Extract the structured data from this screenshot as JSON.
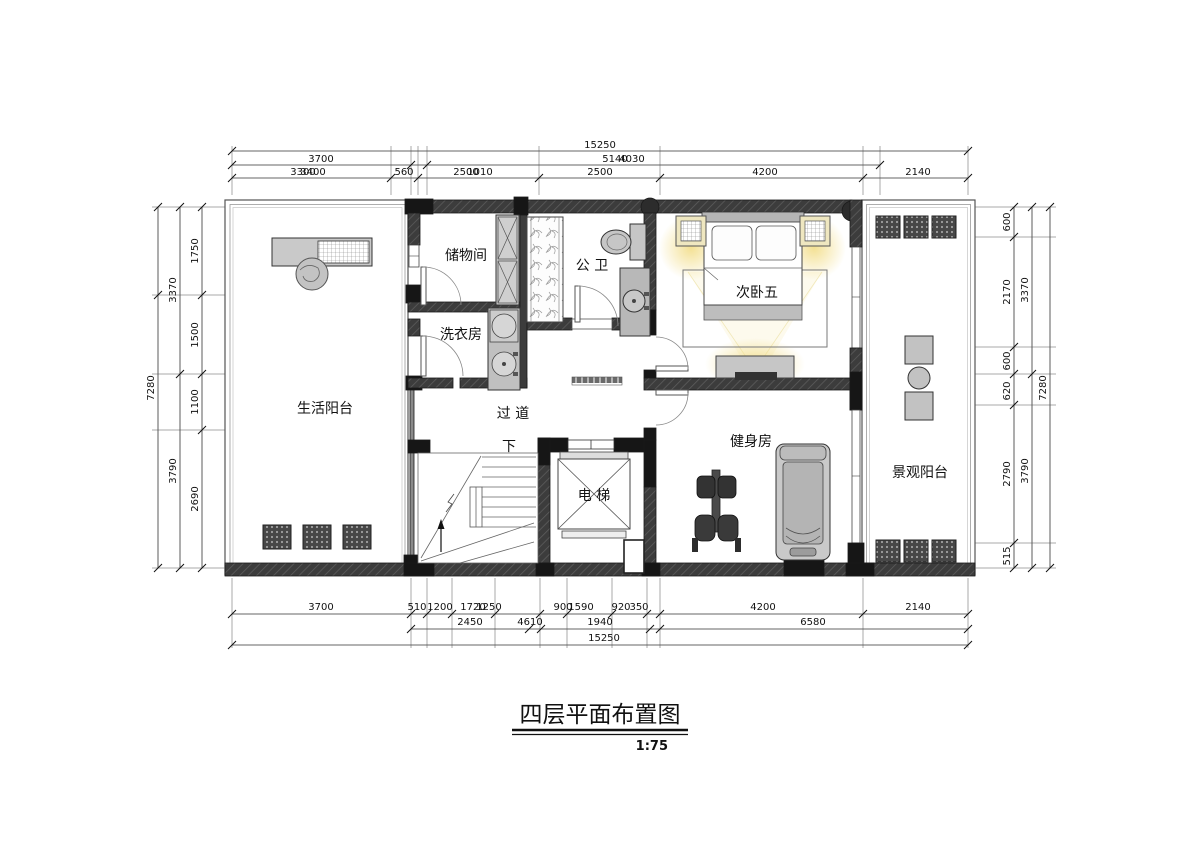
{
  "title": {
    "text": "四层平面布置图",
    "scale": "1:75"
  },
  "rooms": {
    "life_balcony": "生活阳台",
    "storage": "储物间",
    "laundry": "洗衣房",
    "bath": "公 卫",
    "bedroom5": "次卧五",
    "hallway": "过 道",
    "stairs_down": "下",
    "elevator": "电 梯",
    "gym": "健身房",
    "view_balcony": "景观阳台"
  },
  "dims": {
    "top_row1": [
      "15250"
    ],
    "top_row2": [
      "3700",
      "5140",
      "4030"
    ],
    "top_row3": [
      "3300",
      "3400",
      "560",
      "2500",
      "1010",
      "2500",
      "4200",
      "2140"
    ],
    "bottom_row1": [
      "3700",
      "510",
      "1200",
      "1720",
      "1250",
      "900",
      "1590",
      "920",
      "350",
      "4200",
      "2140"
    ],
    "bottom_row2": [
      "2450",
      "4610",
      "1940",
      "6580"
    ],
    "bottom_row3": [
      "15250"
    ],
    "left_outer": "7280",
    "left_mid": [
      "3370",
      "3790"
    ],
    "left_inner": [
      "1750",
      "1500",
      "1100",
      "2690"
    ],
    "right_inner": [
      "600",
      "2170",
      "600",
      "620",
      "2790",
      "515"
    ],
    "right_mid": [
      "3370",
      "3790"
    ],
    "right_outer": "7280"
  },
  "colors": {
    "wall": "#3c3c3c",
    "wall_black": "#161616",
    "furniture": "#c6c6c6",
    "glow": "#f3df8e",
    "line": "#222222"
  }
}
